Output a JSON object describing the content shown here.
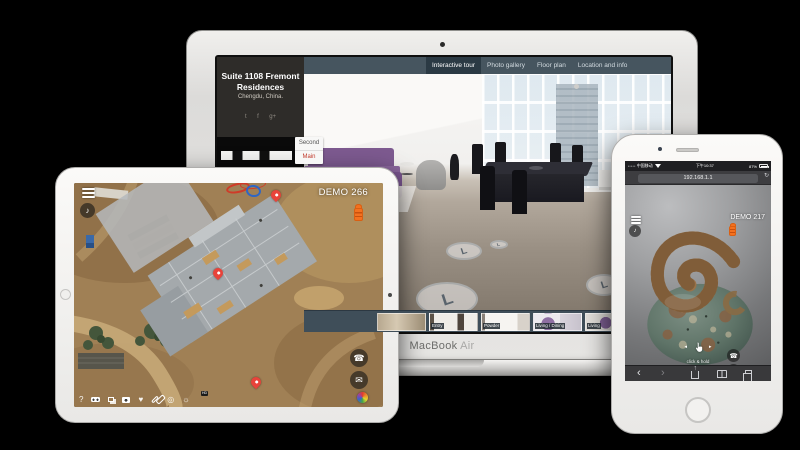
{
  "glyphs": {
    "help": "?",
    "music": "♪",
    "phone": "☎",
    "email": "✉",
    "heart": "♥",
    "gear": "☼",
    "record": "◎",
    "back": "‹",
    "forward": "›",
    "refresh": "↻",
    "hotspot": "L",
    "share": "↑",
    "signal": "•••••",
    "arrow_left": "◂",
    "arrow_right": "▸"
  },
  "macbook": {
    "brand_primary": "MacBook",
    "brand_secondary": "Air",
    "nav": {
      "tabs": [
        {
          "label": "Interactive tour",
          "active": true
        },
        {
          "label": "Photo gallery",
          "active": false
        },
        {
          "label": "Floor plan",
          "active": false
        },
        {
          "label": "Location and info",
          "active": false
        }
      ]
    },
    "sidebar": {
      "title": "Suite 1108 Fremont Residences",
      "location": "Chengdu, China.",
      "social": {
        "twitter": "t",
        "facebook": "f",
        "gplus": "g+"
      }
    },
    "floor_selector": {
      "second": "Second",
      "main": "Main"
    },
    "thumbnails": [
      {
        "label": ""
      },
      {
        "label": "Entry"
      },
      {
        "label": "Powder"
      },
      {
        "label": "Living / Dining"
      },
      {
        "label": "Living"
      },
      {
        "label": ""
      }
    ]
  },
  "ipad": {
    "demo_label": "DEMO 266",
    "hd_badge": "HD"
  },
  "iphone": {
    "status": {
      "carrier": "中国移动",
      "time": "下午10:37",
      "battery": "87%"
    },
    "address": "192.168.1.1",
    "demo_label": "DEMO 217",
    "hint_line1": "click & hold",
    "hint_line2": "to rotate",
    "hd_badge": "HD"
  },
  "colors": {
    "accent_orange": "#f4711f",
    "pin_red": "#e8433a",
    "navbar": "#46555f",
    "active_tab": "#2b3a44"
  }
}
